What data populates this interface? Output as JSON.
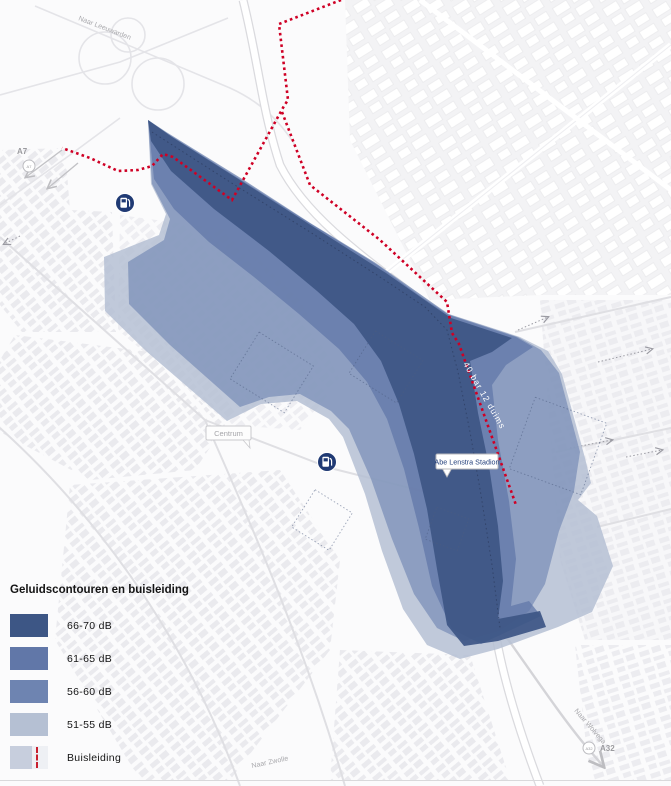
{
  "legend": {
    "title": "Geluidscontouren en buisleiding",
    "items": [
      {
        "label": "66-70 dB",
        "color": "#3d5685"
      },
      {
        "label": "61-65 dB",
        "color": "#6177a8"
      },
      {
        "label": "56-60 dB",
        "color": "#6e84b1"
      },
      {
        "label": "51-55 dB",
        "color": "#b5c0d3"
      },
      {
        "label": "Buisleiding",
        "color": "#c7cedd",
        "color_right": "#eef0f4",
        "line_color": "#c81f2e"
      }
    ]
  },
  "map": {
    "labels": {
      "naar_leeuwarden": "Naar Leeuwarden",
      "a7": "A7",
      "centrum": "Centrum",
      "stadium": "Abe Lenstra Stadion",
      "pipeline_annotation": "40 bar 12 duims",
      "naar_zwolle": "Naar Zwolle",
      "naar_wolvega": "Naar Wolvega",
      "a32": "A32"
    },
    "pipeline_color": "#cf0025",
    "markers": [
      {
        "name": "fuel-station-icon"
      },
      {
        "name": "fuel-station-icon"
      }
    ]
  }
}
